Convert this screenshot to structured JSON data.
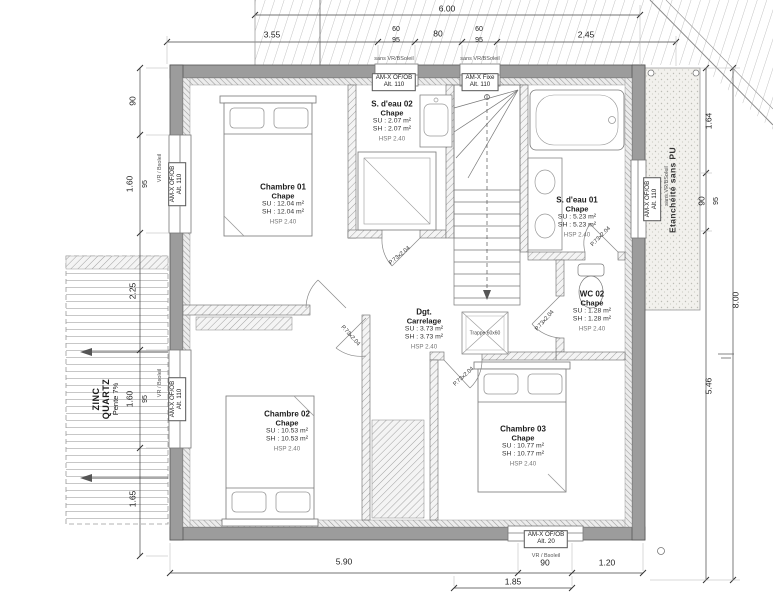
{
  "plan": {
    "rooms": {
      "chambre01": {
        "name": "Chambre 01",
        "finish": "Chape",
        "su": "SU : 12.04 m²",
        "sh": "SH : 12.04 m²",
        "hsp": "HSP 2.40"
      },
      "sdeau02": {
        "name": "S. d'eau 02",
        "finish": "Chape",
        "su": "SU : 2.07 m²",
        "sh": "SH : 2.07 m²",
        "hsp": "HSP 2.40"
      },
      "sdeau01": {
        "name": "S. d'eau 01",
        "finish": "Chape",
        "su": "SU : 5.23 m²",
        "sh": "SH : 5.23 m²",
        "hsp": "HSP 2.40"
      },
      "wc02": {
        "name": "WC 02",
        "finish": "Chape",
        "su": "SU : 1.28 m²",
        "sh": "SH : 1.28 m²",
        "hsp": "HSP 2.40"
      },
      "degagement": {
        "name": "Dgt.",
        "finish": "Carrelage",
        "su": "SU : 3.73 m²",
        "sh": "SH : 3.73 m²",
        "hsp": "HSP 2.40"
      },
      "chambre02": {
        "name": "Chambre 02",
        "finish": "Chape",
        "su": "SU : 10.53 m²",
        "sh": "SH : 10.53 m²",
        "hsp": "HSP 2.40"
      },
      "chambre03": {
        "name": "Chambre 03",
        "finish": "Chape",
        "su": "SU : 10.77 m²",
        "sh": "SH : 10.77 m²",
        "hsp": "HSP 2.40"
      }
    },
    "windows": {
      "top1": {
        "line1": "AM-X OF/OB",
        "line2": "Alt. 110",
        "note": "sans VR/BSoleil"
      },
      "top2": {
        "line1": "AM-X Fixe",
        "line2": "Alt. 110",
        "note": "sans VR/BSoleil"
      },
      "left1": {
        "line1": "AM-X OF/OB",
        "line2": "Alt. 110",
        "note": "VR / Bsoleil"
      },
      "left2": {
        "line1": "AM-X OF/OB",
        "line2": "Alt. 110",
        "note": "VR / Bsoleil"
      },
      "right1": {
        "line1": "AM-X OF/OB",
        "line2": "Alt. 110",
        "note": "sans VR/BSoleil"
      },
      "bottom1": {
        "line1": "AM-X OF/OB",
        "line2": "Alt. 20",
        "note": "VR / Bsoleil"
      }
    },
    "annotations": {
      "zinc_line1": "ZINC",
      "zinc_line2": "QUARTZ",
      "zinc_pente": "Pente 7%",
      "etancheite": "Etanchéité sans PU",
      "trappe": "Trappe 60x60",
      "door_label": "P.73x2.04"
    },
    "dimensions": {
      "top_total": "6.00",
      "top_chain": {
        "a": "3.55",
        "b": "60",
        "b2": "95",
        "c": "80",
        "d": "60",
        "d2": "95",
        "e": "2.45"
      },
      "left_chain": {
        "a": "90",
        "b": "1.60",
        "b2": "95",
        "c": "2.25",
        "d": "1.60",
        "d2": "95",
        "e": "1.65"
      },
      "right_chain": {
        "a": "1.64",
        "b": "90",
        "b2": "95",
        "total": "8.00",
        "c": "5.46"
      },
      "bottom_chain": {
        "a": "5.90",
        "b": "90",
        "c": "1.20",
        "b2": "1.85"
      }
    }
  }
}
